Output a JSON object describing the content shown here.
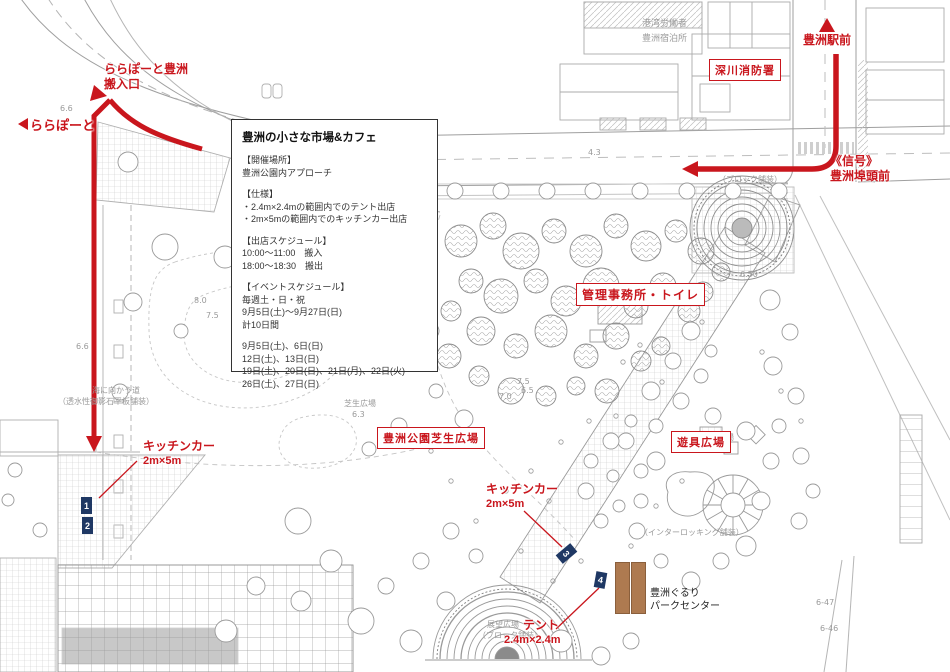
{
  "colors": {
    "accent_red": "#c9161d",
    "marker_navy": "#1f3864",
    "bar_brown": "#ae7a50"
  },
  "icons": {
    "up_arrowhead": "▲",
    "left_arrowhead": "◀",
    "down_arrowhead": "▼"
  },
  "info_box": {
    "title": "豊洲の小さな市場&カフェ",
    "sections": [
      {
        "heading": "【開催場所】",
        "lines": [
          "豊洲公園内アプローチ"
        ]
      },
      {
        "heading": "【仕様】",
        "lines": [
          "・2.4m×2.4mの範囲内でのテント出店",
          "・2m×5mの範囲内でのキッチンカー出店"
        ]
      },
      {
        "heading": "【出店スケジュール】",
        "lines": [
          "10:00～11:00　搬入",
          "18:00～18:30　搬出"
        ]
      },
      {
        "heading": "【イベントスケジュール】",
        "lines": [
          "毎週土・日・祝",
          "9月5日(土)～9月27日(日)",
          "計10日間"
        ]
      },
      {
        "heading": "",
        "lines": [
          "9月5日(土)、6日(日)",
          "12日(土)、13日(日)",
          "19日(土)、20日(日)、21日(月)、22日(火)",
          "26日(土)、27日(日)"
        ]
      }
    ]
  },
  "labels": {
    "lalaport_line1": "ららぽーと豊洲",
    "lalaport_line2": "搬入口",
    "lalaport_direction": "ららぽーと",
    "station": "豊洲駅前",
    "fire_station": "深川消防署",
    "signal": "《信号》",
    "signal_place": "豊洲埠頭前",
    "admin_office": "管理事務所・トイレ",
    "lawn_plaza": "豊洲公園芝生広場",
    "playground": "遊具広場",
    "kitchen_car": "キッチンカー",
    "kitchen_car_size": "2m×5m",
    "tent": "テント",
    "tent_size": "2.4m×2.4m",
    "park_center_line1": "豊洲ぐるり",
    "park_center_line2": "パークセンター"
  },
  "markers": [
    {
      "id": "1"
    },
    {
      "id": "2"
    },
    {
      "id": "3"
    },
    {
      "id": "4"
    }
  ],
  "map_texts": [
    {
      "text": "港湾労働者",
      "x": 642,
      "y": 16,
      "size": 9
    },
    {
      "text": "豊洲宿泊所",
      "x": 642,
      "y": 31,
      "size": 9
    },
    {
      "text": "幹線道路3号",
      "x": 384,
      "y": 141,
      "size": 9,
      "rot": -3
    },
    {
      "text": "幹線道路3号",
      "x": 376,
      "y": 157,
      "size": 9,
      "rot": -3
    },
    {
      "text": "4.3",
      "x": 588,
      "y": 148,
      "size": 8
    },
    {
      "text": "（ブロック舗装）",
      "x": 718,
      "y": 174,
      "size": 8
    },
    {
      "text": "6.6",
      "x": 60,
      "y": 104,
      "size": 8
    },
    {
      "text": "6.6",
      "x": 76,
      "y": 342,
      "size": 8
    },
    {
      "text": "海に向かう道",
      "x": 92,
      "y": 385,
      "size": 8
    },
    {
      "text": "（透水性御影石平板舗装）",
      "x": 58,
      "y": 396,
      "size": 8
    },
    {
      "text": "8.0",
      "x": 194,
      "y": 296,
      "size": 8
    },
    {
      "text": "7.5",
      "x": 206,
      "y": 311,
      "size": 8
    },
    {
      "text": "芝生広場",
      "x": 344,
      "y": 398,
      "size": 8
    },
    {
      "text": "6.3",
      "x": 352,
      "y": 410,
      "size": 8
    },
    {
      "text": "7.5",
      "x": 517,
      "y": 377,
      "size": 8
    },
    {
      "text": "6.5",
      "x": 521,
      "y": 386,
      "size": 8
    },
    {
      "text": "7.0",
      "x": 499,
      "y": 392,
      "size": 8
    },
    {
      "text": "展望広場",
      "x": 487,
      "y": 619,
      "size": 8
    },
    {
      "text": "（ブロック舗装）",
      "x": 478,
      "y": 630,
      "size": 8
    },
    {
      "text": "（インターロッキング舗装）",
      "x": 640,
      "y": 527,
      "size": 8
    },
    {
      "text": "広場",
      "x": 718,
      "y": 432,
      "size": 8
    },
    {
      "text": "6.50",
      "x": 740,
      "y": 270,
      "size": 8
    },
    {
      "text": "6-47",
      "x": 816,
      "y": 598,
      "size": 8
    },
    {
      "text": "6-46",
      "x": 820,
      "y": 624,
      "size": 8
    }
  ]
}
